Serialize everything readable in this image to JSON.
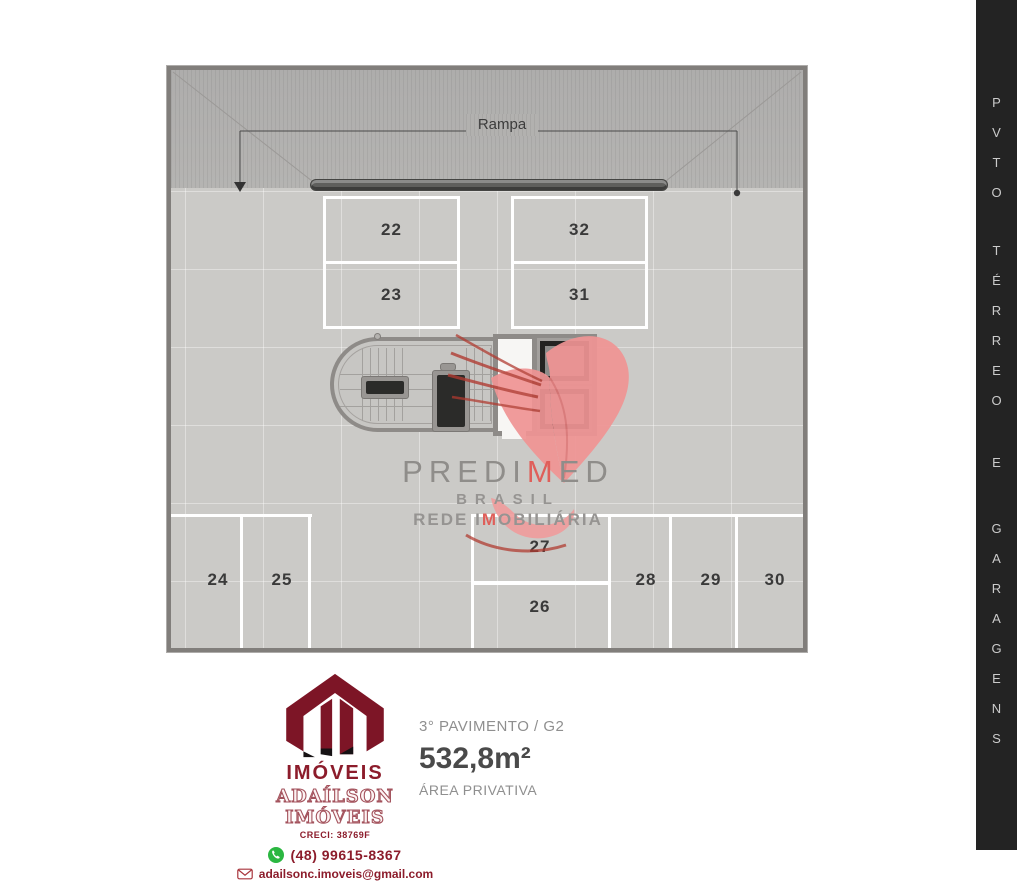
{
  "side_strip": {
    "words": [
      "PVTO",
      "TÉRREO",
      "E",
      "GARAGENS"
    ]
  },
  "plan": {
    "ramp_label": "Rampa",
    "stalls": {
      "s22": "22",
      "s23": "23",
      "s24": "24",
      "s25": "25",
      "s26": "26",
      "s27": "27",
      "s28": "28",
      "s29": "29",
      "s30": "30",
      "s31": "31",
      "s32": "32"
    }
  },
  "watermark": {
    "brand_pre": "PREDI",
    "brand_accent": "M",
    "brand_post": "ED",
    "country": "BRASIL",
    "tagline_pre": "REDE I",
    "tagline_accent": "M",
    "tagline_post": "OBILIÁRIA"
  },
  "agency": {
    "logo_text": "IMÓVEIS",
    "name": "ADAÍLSON IMÓVEIS",
    "creci": "CRECI: 38769F",
    "phone": "(48) 99615-8367",
    "email": "adailsonc.imoveis@gmail.com"
  },
  "unit_info": {
    "floor": "3° PAVIMENTO / G2",
    "area": "532,8m²",
    "area_label": "ÁREA PRIVATIVA"
  },
  "colors": {
    "accent_red": "#df5f5a",
    "watermark_gray": "#8f8d8a",
    "brand_maroon": "#8c1c2b",
    "whatsapp_green": "#2bb741",
    "strip_bg": "#232323",
    "floor_gray": "#cbcac7",
    "ramp_gray": "#b2b1af"
  }
}
